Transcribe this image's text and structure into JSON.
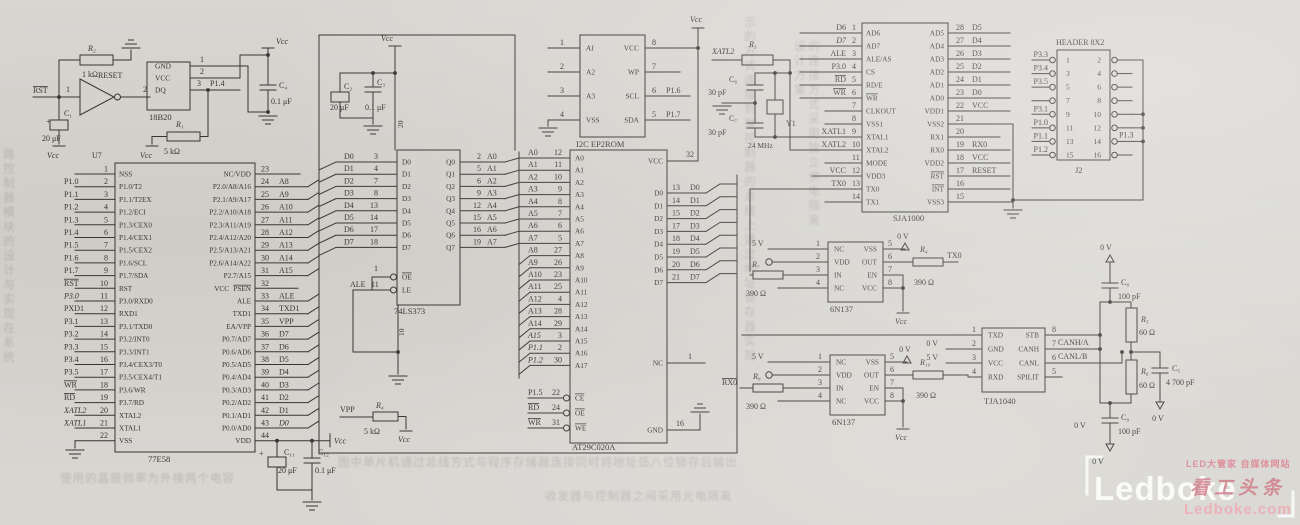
{
  "colors": {
    "ink": "#35332f",
    "paper": "#d8d6d1",
    "watermark_red": "#c95f6e",
    "watermark_pink": "#eda6ae",
    "watermark_white": "#fbfbf9"
  },
  "symbols": {
    "vcc": "Vcc",
    "v5": "5 V",
    "v0": "0 V",
    "plus": "+"
  },
  "nets": {
    "rst": "RST",
    "reset": "RESET",
    "inv_in": "1",
    "inv_out": "2",
    "vpp": "VPP",
    "tx0": "TX0",
    "rx0": "RX0",
    "xatl2": "XATL2"
  },
  "chips": {
    "u7": {
      "ref": "U7",
      "name": "77E58",
      "left": [
        {
          "n": "1"
        },
        {
          "n": "2",
          "ext": "P1.0"
        },
        {
          "n": "3",
          "ext": "P1.1"
        },
        {
          "n": "4",
          "ext": "P1.2"
        },
        {
          "n": "5",
          "ext": "P1.3"
        },
        {
          "n": "6",
          "ext": "P1.4"
        },
        {
          "n": "7",
          "ext": "P1.5"
        },
        {
          "n": "8",
          "ext": "P1.6"
        },
        {
          "n": "9",
          "ext": "P1.7"
        },
        {
          "n": "10",
          "ext": "RST"
        },
        {
          "n": "11",
          "ext": "P3.0"
        },
        {
          "n": "12",
          "ext": "PXD1"
        },
        {
          "n": "13",
          "ext": "P3.1"
        },
        {
          "n": "14",
          "ext": "P3.2"
        },
        {
          "n": "15",
          "ext": "P3.3"
        },
        {
          "n": "16",
          "ext": "P3.4"
        },
        {
          "n": "17",
          "ext": "P3.5"
        },
        {
          "n": "18",
          "ext": "WR"
        },
        {
          "n": "19",
          "ext": "RD"
        },
        {
          "n": "20",
          "ext": "XATL2"
        },
        {
          "n": "21",
          "ext": "XATL1"
        },
        {
          "n": "22"
        }
      ],
      "inner_l": [
        "NSS",
        "P1.0/T2",
        "P1.1/T2EX",
        "P1.2/ECI",
        "P1.3/CEX0",
        "P1.4/CEX1",
        "P1.5/CEX2",
        "P1.6/SCL",
        "P1.7/SDA",
        "RST",
        "P3.0/RXD0",
        "RXD1",
        "P3.1/TXD0",
        "P3.2/INT0",
        "P3.3/INT1",
        "P3.4/CEX3/T0",
        "P3.5/CEX4/T1",
        "P3.6/WR",
        "P3.7/RD",
        "XTAL2",
        "XTAL1",
        "VSS"
      ],
      "right": [
        {
          "n": "23"
        },
        {
          "n": "24",
          "ext": "A8"
        },
        {
          "n": "25",
          "ext": "A9"
        },
        {
          "n": "26",
          "ext": "A10"
        },
        {
          "n": "27",
          "ext": "A11"
        },
        {
          "n": "28",
          "ext": "A12"
        },
        {
          "n": "29",
          "ext": "A13"
        },
        {
          "n": "30",
          "ext": "A14"
        },
        {
          "n": "31",
          "ext": "A15"
        },
        {
          "n": "32"
        },
        {
          "n": "33",
          "ext": "ALE"
        },
        {
          "n": "34",
          "ext": "TXD1"
        },
        {
          "n": "35",
          "ext": "VPP"
        },
        {
          "n": "36",
          "ext": "D7"
        },
        {
          "n": "37",
          "ext": "D6"
        },
        {
          "n": "38",
          "ext": "D5"
        },
        {
          "n": "39",
          "ext": "D4"
        },
        {
          "n": "40",
          "ext": "D3"
        },
        {
          "n": "41",
          "ext": "D2"
        },
        {
          "n": "42",
          "ext": "D1"
        },
        {
          "n": "43",
          "ext": "D0"
        },
        {
          "n": "44"
        }
      ],
      "inner_r": [
        "NC/VDD",
        "P2.0/A8/A16",
        "P2.1/A9/A17",
        "P2.2/A10/A18",
        "P2.3/A11/A19",
        "P2.4/A12/A20",
        "P2.5/A13/A21",
        "P2.6/A14/A22",
        "P2.7/A15",
        "PSEN",
        "ALE",
        "TXD1",
        "EA/VPP",
        "P0.7/AD7",
        "P0.6/AD6",
        "P0.5/AD5",
        "P0.4/AD4",
        "P0.3/AD3",
        "P0.2/AD2",
        "P0.1/AD1",
        "P0.0/AD0",
        "VDD"
      ],
      "vcc_inner": "VCC"
    },
    "latch": {
      "name": "74LS373",
      "d": [
        {
          "ext": "D0",
          "n": "3"
        },
        {
          "ext": "D1",
          "n": "4"
        },
        {
          "ext": "D2",
          "n": "7"
        },
        {
          "ext": "D3",
          "n": "8"
        },
        {
          "ext": "D4",
          "n": "13"
        },
        {
          "ext": "D5",
          "n": "14"
        },
        {
          "ext": "D6",
          "n": "17"
        },
        {
          "ext": "D7",
          "n": "18"
        }
      ],
      "inner_d": [
        "D0",
        "D1",
        "D2",
        "D3",
        "D4",
        "D5",
        "D6",
        "D7"
      ],
      "q": [
        {
          "n": "2",
          "ext": "A0"
        },
        {
          "n": "5",
          "ext": "A1"
        },
        {
          "n": "6",
          "ext": "A2"
        },
        {
          "n": "9",
          "ext": "A3"
        },
        {
          "n": "12",
          "ext": "A4"
        },
        {
          "n": "15",
          "ext": "A5"
        },
        {
          "n": "16",
          "ext": "A6"
        },
        {
          "n": "19",
          "ext": "A7"
        }
      ],
      "inner_q": [
        "Q0",
        "Q1",
        "Q2",
        "Q3",
        "Q4",
        "Q5",
        "Q6",
        "Q7"
      ],
      "oe": {
        "n": "1",
        "inn": "OE"
      },
      "le": {
        "ext": "ALE",
        "n": "11",
        "inn": "LE"
      },
      "gnd_n": "10",
      "vcc_n": "20"
    },
    "eeprom": {
      "name": "I2C EP2ROM",
      "left": [
        {
          "n": "1",
          "inn": "A1"
        },
        {
          "n": "2",
          "inn": "A2"
        },
        {
          "n": "3",
          "inn": "A3"
        },
        {
          "n": "4",
          "inn": "VSS"
        }
      ],
      "right": [
        {
          "n": "8",
          "inn": "VCC"
        },
        {
          "n": "7",
          "inn": "WP"
        },
        {
          "n": "6",
          "inn": "SCL",
          "ext": "P1.6"
        },
        {
          "n": "5",
          "inn": "SDA",
          "ext": "P1.7"
        }
      ]
    },
    "flash": {
      "name": "AT29C020A",
      "addr": [
        {
          "ext": "A0",
          "n": "12",
          "inn": "A0"
        },
        {
          "ext": "A1",
          "n": "11",
          "inn": "A1"
        },
        {
          "ext": "A2",
          "n": "10",
          "inn": "A2"
        },
        {
          "ext": "A3",
          "n": "9",
          "inn": "A3"
        },
        {
          "ext": "A4",
          "n": "8",
          "inn": "A4"
        },
        {
          "ext": "A5",
          "n": "7",
          "inn": "A5"
        },
        {
          "ext": "A6",
          "n": "6",
          "inn": "A6"
        },
        {
          "ext": "A7",
          "n": "5",
          "inn": "A7"
        },
        {
          "ext": "A8",
          "n": "27",
          "inn": "A8"
        },
        {
          "ext": "A9",
          "n": "26",
          "inn": "A9"
        },
        {
          "ext": "A10",
          "n": "23",
          "inn": "A10"
        },
        {
          "ext": "A11",
          "n": "25",
          "inn": "A11"
        },
        {
          "ext": "A12",
          "n": "4",
          "inn": "A12"
        },
        {
          "ext": "A13",
          "n": "28",
          "inn": "A13"
        },
        {
          "ext": "A14",
          "n": "29",
          "inn": "A14"
        },
        {
          "ext": "A15",
          "n": "3",
          "inn": "A15"
        },
        {
          "ext": "P1.1",
          "n": "2",
          "inn": "A16"
        },
        {
          "ext": "P1.2",
          "n": "30",
          "inn": "A17"
        }
      ],
      "ctl": [
        {
          "ext": "P1.5",
          "n": "22",
          "inn": "CE"
        },
        {
          "ext": "RD",
          "n": "24",
          "inn": "OE"
        },
        {
          "ext": "WR",
          "n": "31",
          "inn": "WE"
        }
      ],
      "right": [
        {
          "n": "32",
          "inn": "VCC"
        },
        {
          "n": "13",
          "ext": "D0",
          "inn": "D0"
        },
        {
          "n": "14",
          "ext": "D1",
          "inn": "D1"
        },
        {
          "n": "15",
          "ext": "D2",
          "inn": "D2"
        },
        {
          "n": "17",
          "ext": "D3",
          "inn": "D3"
        },
        {
          "n": "18",
          "ext": "D4",
          "inn": "D4"
        },
        {
          "n": "19",
          "ext": "D5",
          "inn": "D5"
        },
        {
          "n": "20",
          "ext": "D6",
          "inn": "D6"
        },
        {
          "n": "21",
          "ext": "D7",
          "inn": "D7"
        },
        {
          "n": "1",
          "inn": "NC"
        },
        {
          "n": "16",
          "inn": "GND"
        }
      ]
    },
    "can": {
      "name": "SJA1000",
      "left": [
        {
          "n": "1",
          "ext": "D6"
        },
        {
          "n": "2",
          "ext": "D7"
        },
        {
          "n": "3",
          "ext": "ALE"
        },
        {
          "n": "4",
          "ext": "P3.0"
        },
        {
          "n": "5",
          "ext": "RD"
        },
        {
          "n": "6",
          "ext": "WR"
        },
        {
          "n": "7"
        },
        {
          "n": "8"
        },
        {
          "n": "9",
          "ext": "XATL1"
        },
        {
          "n": "10",
          "ext": "XATL2"
        },
        {
          "n": "11"
        },
        {
          "n": "12",
          "ext": "VCC"
        },
        {
          "n": "13",
          "ext": "TX0"
        },
        {
          "n": "14"
        }
      ],
      "inner_l": [
        "AD6",
        "AD7",
        "ALE/AS",
        "CS",
        "RD/E",
        "WR",
        "CLKOUT",
        "VSS1",
        "XTAL1",
        "XTAL2",
        "MODE",
        "VDD3",
        "TX0",
        "TX1"
      ],
      "right": [
        {
          "n": "28",
          "ext": "D5"
        },
        {
          "n": "27",
          "ext": "D4"
        },
        {
          "n": "26",
          "ext": "D3"
        },
        {
          "n": "25",
          "ext": "D2"
        },
        {
          "n": "24",
          "ext": "D1"
        },
        {
          "n": "23",
          "ext": "D0"
        },
        {
          "n": "22",
          "ext": "VCC"
        },
        {
          "n": "21"
        },
        {
          "n": "20"
        },
        {
          "n": "19",
          "ext": "RX0"
        },
        {
          "n": "18",
          "ext": "VCC"
        },
        {
          "n": "17",
          "ext": "RESET"
        },
        {
          "n": "16"
        },
        {
          "n": "15"
        }
      ],
      "inner_r": [
        "AD5",
        "AD4",
        "AD3",
        "AD2",
        "AD1",
        "AD0",
        "VDD1",
        "VSS2",
        "RX1",
        "RX0",
        "VDD2",
        "RST",
        "INT",
        "VSS3"
      ]
    },
    "hdr": {
      "title": "HEADER 8X2",
      "ref": "J2",
      "rows": [
        {
          "ln": "1",
          "rn": "2",
          "lext": "P3.3"
        },
        {
          "ln": "3",
          "rn": "4",
          "lext": "P3.4"
        },
        {
          "ln": "5",
          "rn": "6",
          "lext": "P3.5"
        },
        {
          "ln": "7",
          "rn": "8"
        },
        {
          "ln": "9",
          "rn": "10",
          "lext": "P3.1"
        },
        {
          "ln": "11",
          "rn": "12",
          "lext": "P1.0"
        },
        {
          "ln": "13",
          "rn": "14",
          "lext": "P1.1",
          "rext": "P1.3"
        },
        {
          "ln": "15",
          "rn": "16",
          "lext": "P1.2"
        }
      ]
    },
    "opto1": {
      "name": "6N137",
      "inner_l": [
        "NC",
        "VDD",
        "IN",
        "NC"
      ],
      "inner_r": [
        "VSS",
        "OUT",
        "EN",
        "VCC"
      ],
      "nl": [
        "1",
        "2",
        "3",
        "4"
      ],
      "nr": [
        "5",
        "6",
        "7",
        "8"
      ]
    },
    "opto2": {
      "name": "6N137",
      "inner_l": [
        "NC",
        "VDD",
        "IN",
        "NC"
      ],
      "inner_r": [
        "VSS",
        "OUT",
        "EN",
        "VCC"
      ],
      "nl": [
        "1",
        "2",
        "3",
        "4"
      ],
      "nr": [
        "5",
        "6",
        "7",
        "8"
      ]
    },
    "tja": {
      "name": "TJA1040",
      "inner_l": [
        "TXD",
        "GND",
        "VCC",
        "RXD"
      ],
      "inner_r": [
        "STB",
        "CANH",
        "CANL",
        "SPILIT"
      ],
      "nl": [
        "1",
        "2",
        "3",
        "4"
      ],
      "nr": [
        "8",
        "7",
        "6",
        "5"
      ],
      "canh": "CANH/A",
      "canl": "CANL/B"
    },
    "temp": {
      "name": "18B20",
      "inner": [
        "GND",
        "VCC",
        "DQ"
      ],
      "n": [
        "1",
        "2",
        "3"
      ],
      "dq": "P1.4"
    }
  },
  "parts": {
    "r1": {
      "ref": "R₁",
      "val": "5 kΩ"
    },
    "r2": {
      "ref": "R₂",
      "val": "1 kΩ"
    },
    "r3": {
      "ref": "R₃",
      "val": ""
    },
    "r4": {
      "ref": "R₄",
      "val": "5 kΩ"
    },
    "r4b": {
      "ref": "R₄",
      "val": "390 Ω"
    },
    "r5": {
      "ref": "R₅",
      "val": "60 Ω"
    },
    "r6": {
      "ref": "R₆",
      "val": "60 Ω"
    },
    "r7": {
      "ref": "R₇",
      "val": "390 Ω"
    },
    "r9": {
      "ref": "R₉",
      "val": "390 Ω"
    },
    "r10": {
      "ref": "R₁₀",
      "val": "390 Ω"
    },
    "c1": {
      "ref": "C₁",
      "val": "20 μF"
    },
    "c2": {
      "ref": "C₂",
      "val": "20 μF"
    },
    "c3": {
      "ref": "C₃",
      "val": "0.1 μF"
    },
    "c4": {
      "ref": "C₄",
      "val": "0.1 μF"
    },
    "c5": {
      "ref": "C₅",
      "val": "4 700 pF"
    },
    "c6": {
      "ref": "C₆",
      "val": "30 pF"
    },
    "c7": {
      "ref": "C₇",
      "val": "30 pF"
    },
    "c8": {
      "ref": "C₈",
      "val": "100 pF"
    },
    "c9": {
      "ref": "C₉",
      "val": "100 pF"
    },
    "c11": {
      "ref": "C₁₁",
      "val": "20 μF"
    },
    "c12": {
      "ref": "C₁₂",
      "val": "0.1 μF"
    },
    "y1": {
      "ref": "Y1",
      "val": "24 MHz"
    }
  },
  "watermark": {
    "brand": "Ledboke",
    "tagline": "LED大管家 自媒体网站",
    "slogan": "看工头条",
    "domain": "Ledboke.com"
  },
  "texture": [
    "路控制器模块的设计与实现在系统",
    "示的方式连接到微控制器的总线上通过地址锁存器实现",
    "的连接方式采用独立供电隔离设计方案",
    "图中单片机通过总线方式与程序存储器连接同时将地址低八位锁存后输出",
    "使用的晶振频率为外接两个电容",
    "收发器与控制器之间采用光电隔离"
  ]
}
